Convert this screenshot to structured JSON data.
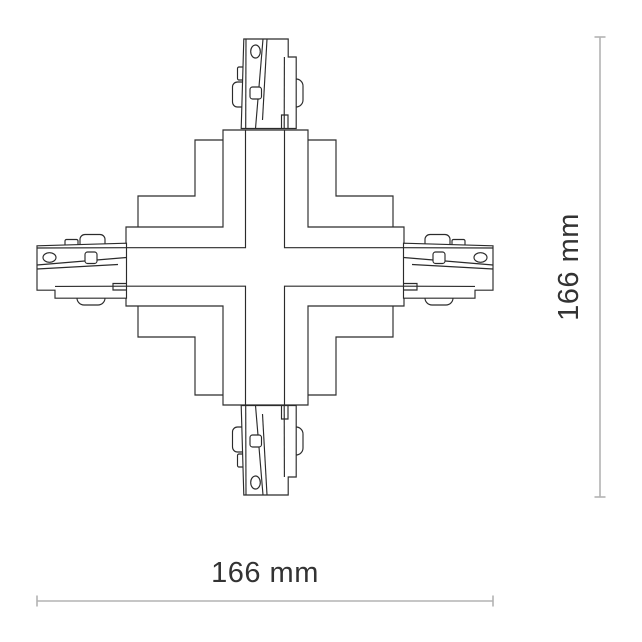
{
  "diagram": {
    "name": "x-connector-technical-drawing",
    "description": "Top view line drawing of an X (cross) track connector with four plug ends",
    "dimension_width": {
      "label": "166 mm",
      "value_mm": 166
    },
    "dimension_height": {
      "label": "166 mm",
      "value_mm": 166
    }
  },
  "colors": {
    "background": "#ffffff",
    "drawing_line": "#2b2b2b",
    "dimension_line": "#b3b3b3",
    "dimension_text": "#333333"
  }
}
